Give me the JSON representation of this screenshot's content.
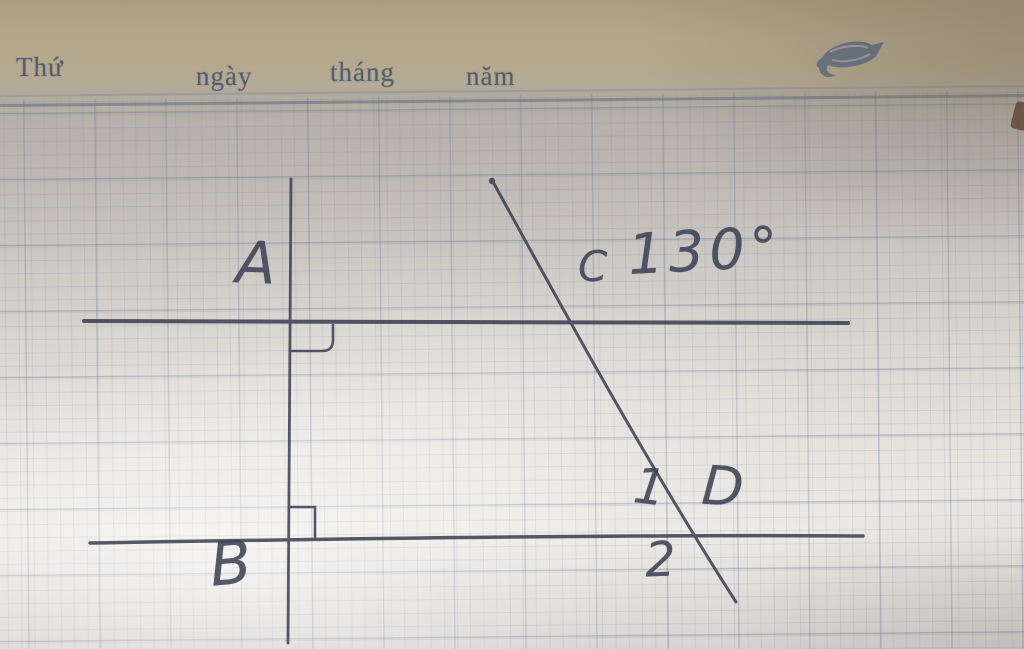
{
  "header": {
    "thu": "Thứ",
    "ngay": "ngày",
    "thang": "tháng",
    "nam": "năm"
  },
  "logo_icon": "shrimp-doodle-icon",
  "diagram": {
    "labels": {
      "point_a": "A",
      "point_b": "B",
      "point_c": "C",
      "point_d": "D",
      "angle_c_value": "130°",
      "angle_1": "1",
      "angle_2": "2"
    }
  },
  "colors": {
    "ink": "#3e4254",
    "grid_line": "#7684a0",
    "grid_bold": "#66738a",
    "paper_top_band": "#b3a78e",
    "paper_bright": "#eceae6",
    "header_text": "#4e5a6e",
    "logo_blue": "#3d5377"
  }
}
